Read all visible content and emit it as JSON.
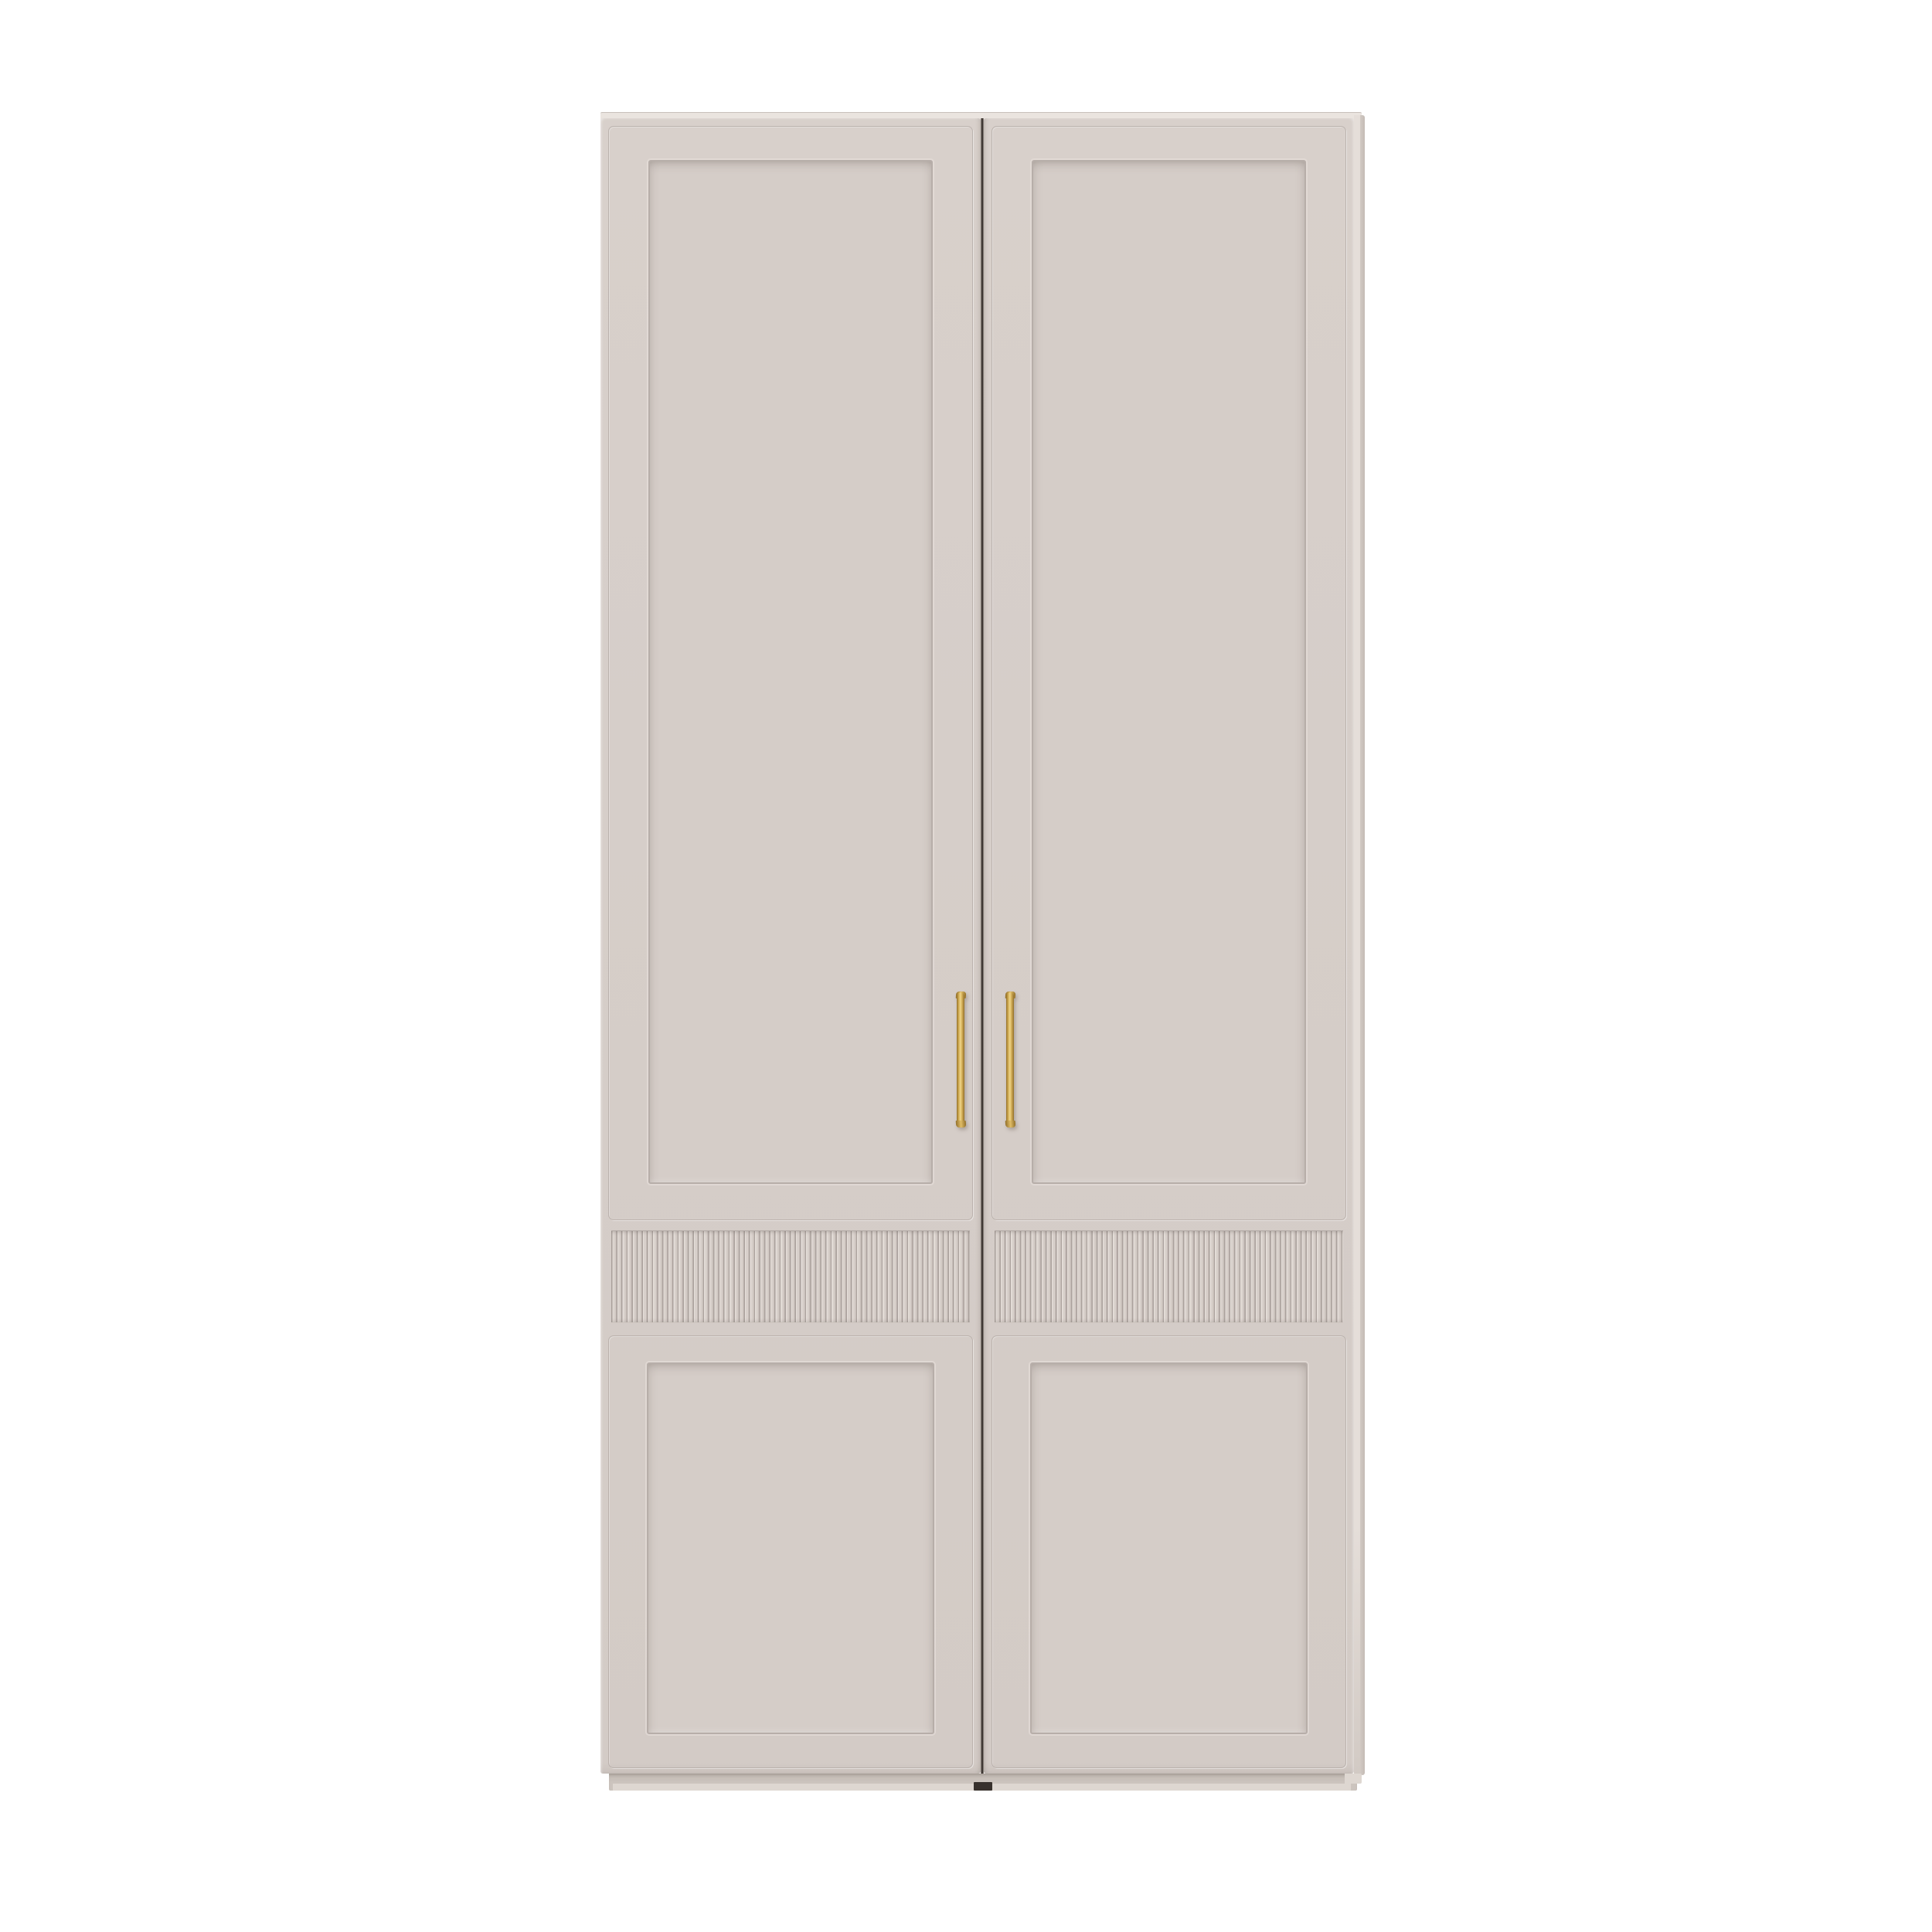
{
  "image": {
    "type": "3d-product-render",
    "subject": "Two-door wardrobe cabinet, front elevation on white background",
    "visible_text": "",
    "background": "#ffffff"
  },
  "cabinet": {
    "finish": "matte greige painted wood",
    "style_features": [
      "two full-height doors",
      "recessed upper shaker panel per door",
      "horizontal fluted reeded band per door",
      "recessed lower shaker panel per door",
      "slim vertical brass bar pull on each door near center gap",
      "recessed plinth base with center notch",
      "thin visible top edge and right side of carcass"
    ],
    "doors": [
      {
        "id": "left-door",
        "handle_side": "right"
      },
      {
        "id": "right-door",
        "handle_side": "left"
      }
    ],
    "colors": {
      "background": "#ffffff",
      "doorFace": "#d8d0cb",
      "doorFaceDark": "#d3cbc6",
      "panelFace": "#d5cdc8",
      "groove": "#b7aea9",
      "topEdge": "#eae4df",
      "sideLight": "#e5ded9",
      "sideDark": "#d2cac4",
      "sideDarker": "#c4bbb5",
      "seam": "#3e3733",
      "plinth": "#ccc4be",
      "plinthShade": "#c2bab3",
      "plinthLight": "#ded7d1",
      "notch": "#38312d",
      "flutedShadow": "#aba29d",
      "flutedLight": "#e6dfda",
      "flutedFace": "#d8d0cb",
      "flutedMid": "#c8bfba",
      "brassLight": "#eed58a",
      "brassMid": "#cfa94f",
      "brassMid2": "#d8b35c",
      "brassCap": "#e0bd67",
      "brassDark": "#93702a"
    }
  }
}
